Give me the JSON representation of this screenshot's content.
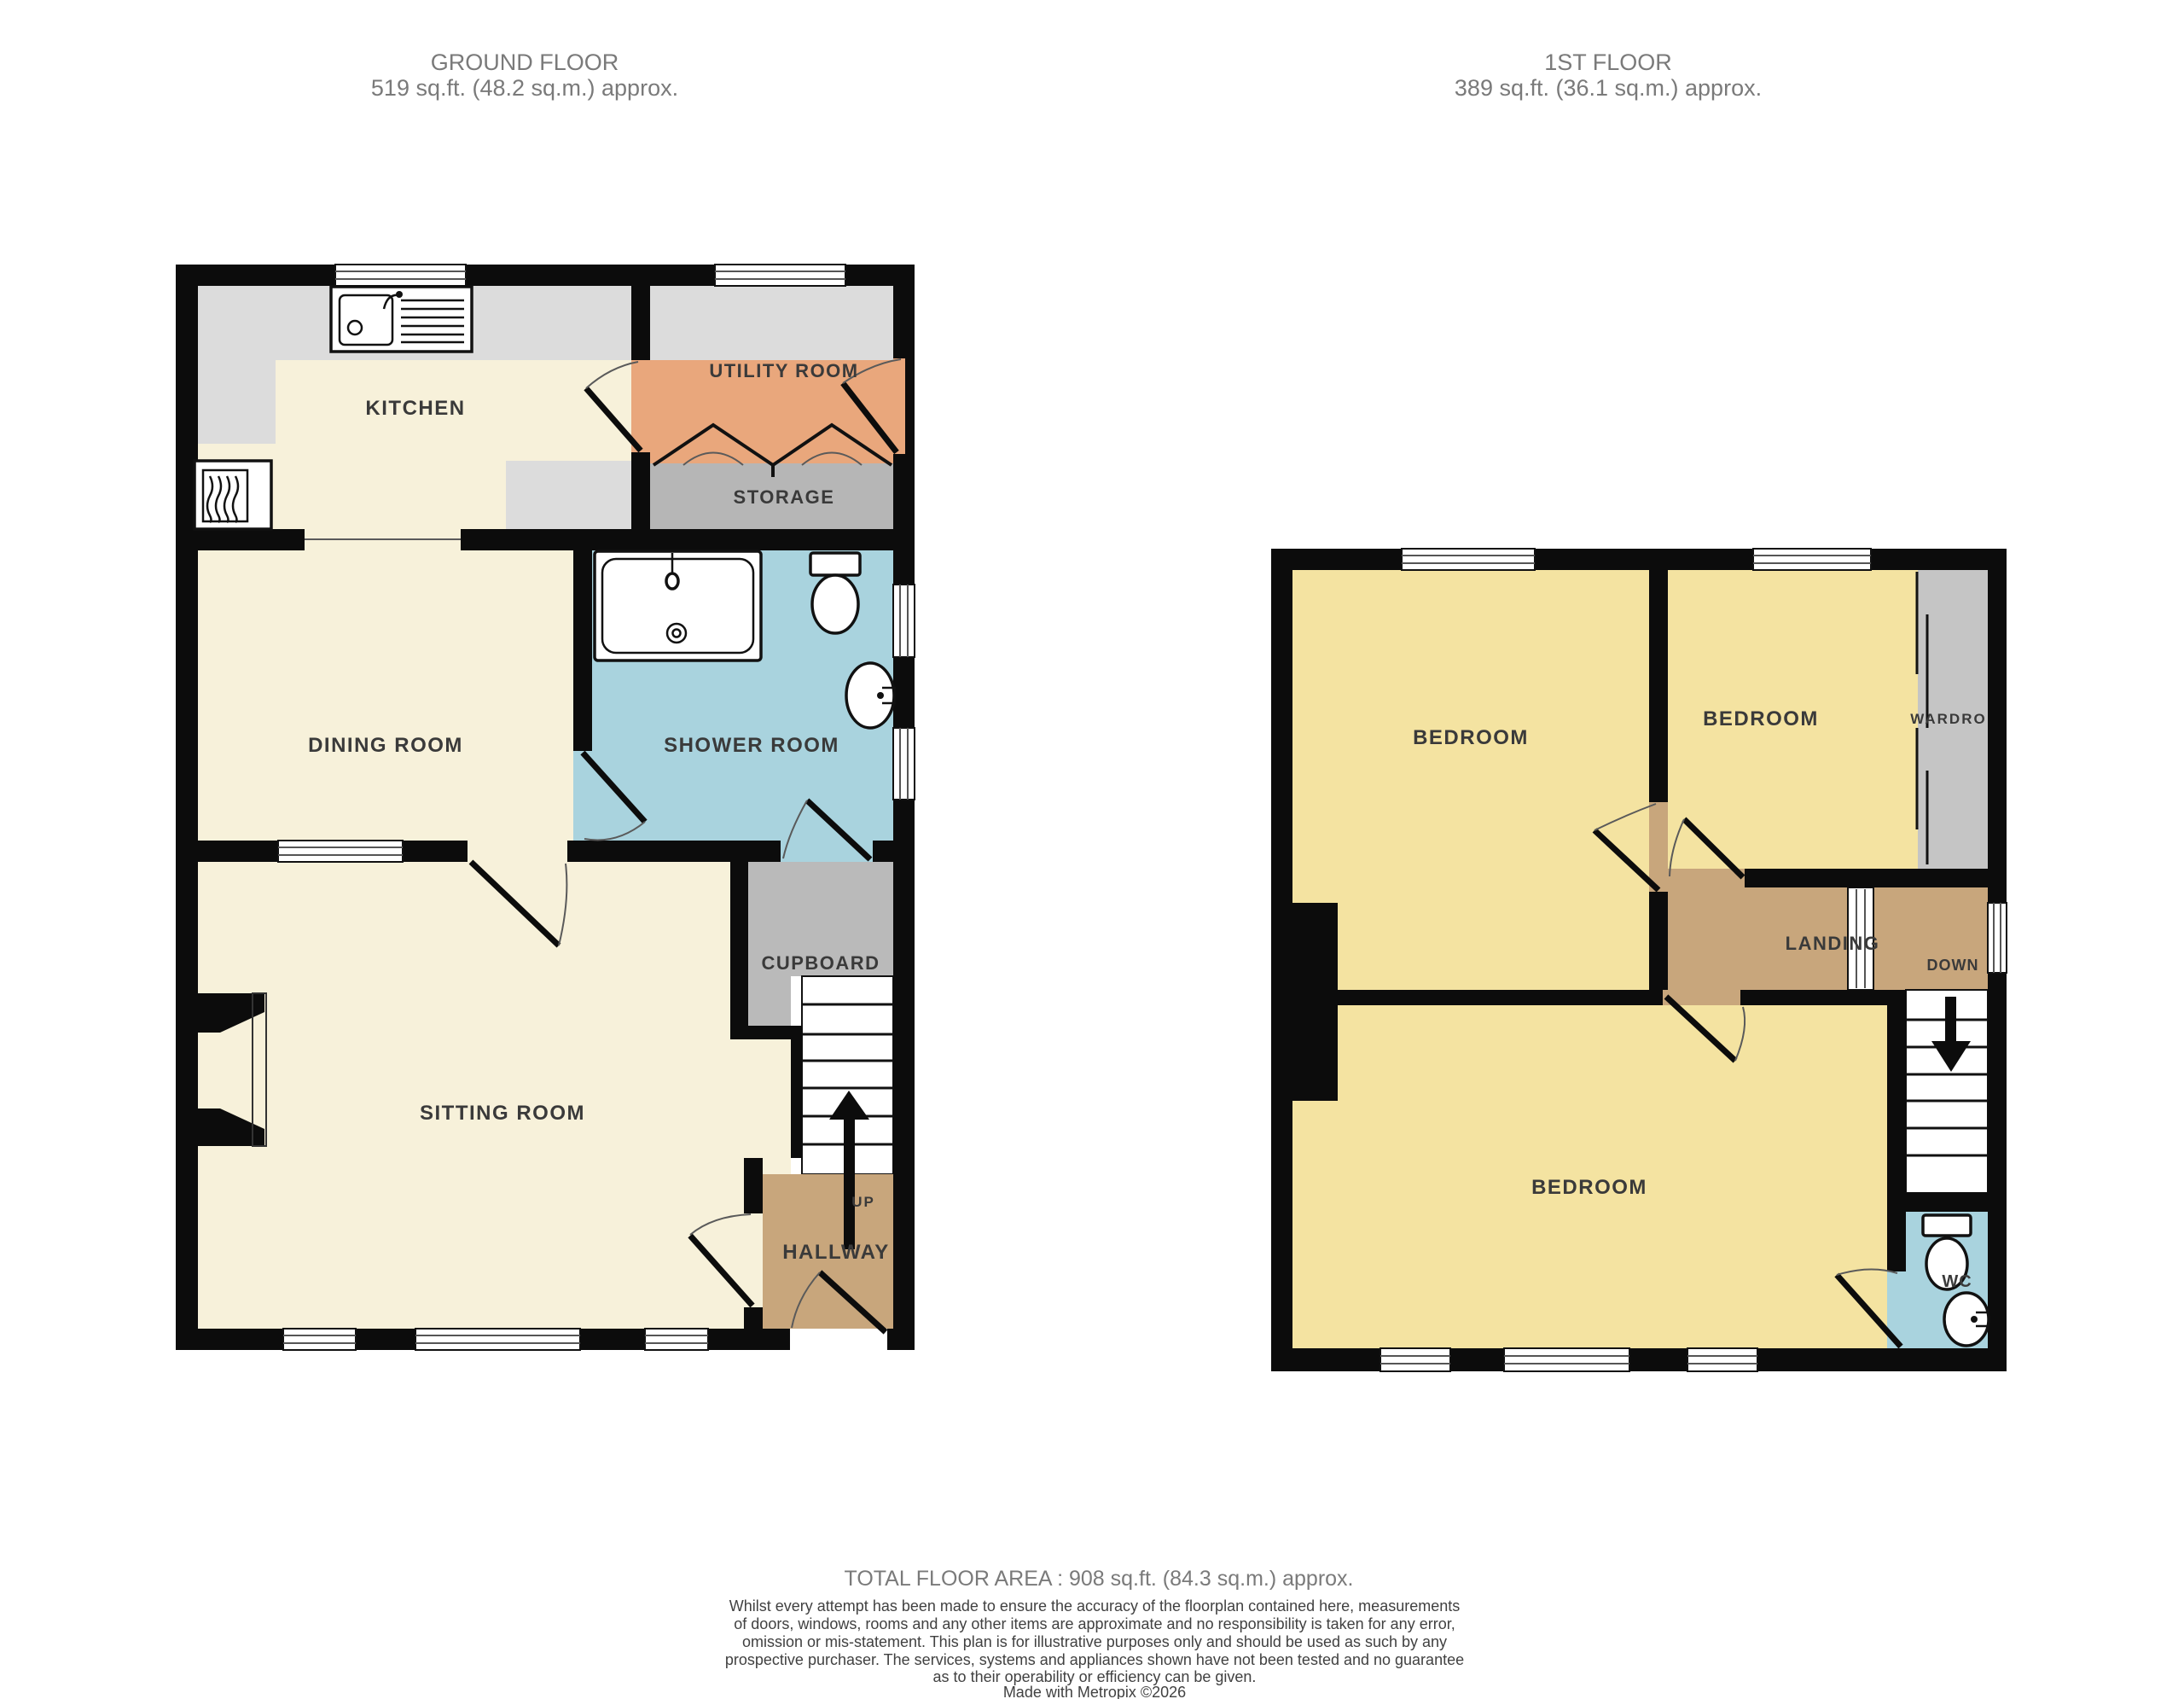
{
  "ground_floor": {
    "title": "GROUND FLOOR",
    "area": "519 sq.ft. (48.2 sq.m.) approx.",
    "rooms": {
      "kitchen": "KITCHEN",
      "utility_room": "UTILITY ROOM",
      "storage": "STORAGE",
      "dining_room": "DINING ROOM",
      "shower_room": "SHOWER ROOM",
      "cupboard": "CUPBOARD",
      "sitting_room": "SITTING ROOM",
      "hallway": "HALLWAY"
    },
    "stairs_label": "UP"
  },
  "first_floor": {
    "title": "1ST FLOOR",
    "area": "389 sq.ft. (36.1 sq.m.) approx.",
    "rooms": {
      "bedroom_left": "BEDROOM",
      "bedroom_right": "BEDROOM",
      "bedroom_bottom": "BEDROOM",
      "wardrobe": "WARDRO",
      "landing": "LANDING",
      "wc": "WC"
    },
    "stairs_label": "DOWN"
  },
  "footer": {
    "total_area": "TOTAL FLOOR AREA : 908 sq.ft. (84.3 sq.m.) approx.",
    "disclaimer": [
      "Whilst every attempt has been made to ensure the accuracy of the floorplan contained here, measurements",
      "of doors, windows, rooms and any other items are approximate and no responsibility is taken for any error,",
      "omission or mis-statement. This plan is for illustrative purposes only and should be used as such by any",
      "prospective purchaser. The services, systems and appliances shown have not been tested and no guarantee",
      "as to their operability or efficiency can be given."
    ],
    "credit": "Made with Metropix ©2026"
  },
  "colors": {
    "wall": "#0c0c0c",
    "floor_cream": "#f7f1da",
    "bedroom_yellow": "#f4e3a1",
    "bathroom_blue": "#a9d3de",
    "utility_orange": "#e9a77c",
    "hallway_tan": "#c8a67c",
    "counter_gray": "#dcdcdc",
    "storage_gray": "#b6b6b6",
    "cupboard_gray": "#bababa",
    "wardrobe_gray": "#c5c5c5"
  }
}
